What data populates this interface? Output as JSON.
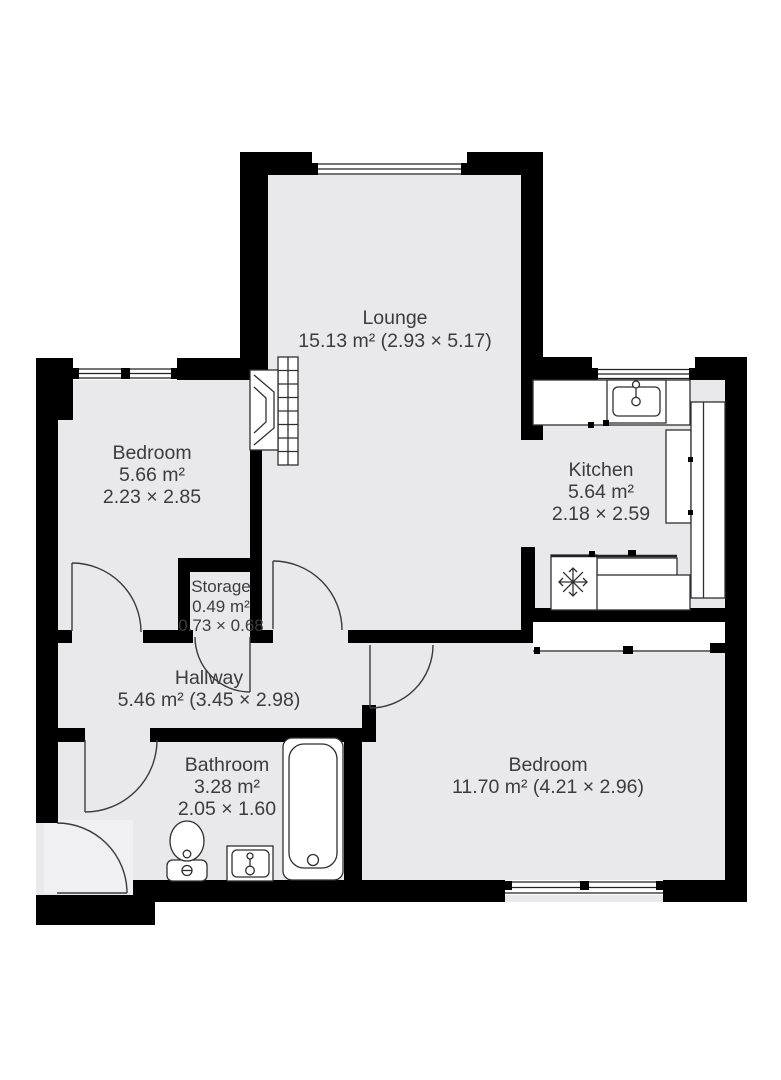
{
  "floorplan": {
    "colors": {
      "background": "#ffffff",
      "floor": "#e9e9ec",
      "wall": "#000000",
      "text": "#3c3c3c",
      "fixture_stroke": "#2f2f2f"
    },
    "rooms": [
      {
        "name": "Lounge",
        "area": "15.13 m² (2.93 × 5.17)"
      },
      {
        "name": "Bedroom",
        "area": "5.66 m²",
        "dims": "2.23 × 2.85"
      },
      {
        "name": "Kitchen",
        "area": "5.64 m²",
        "dims": "2.18 × 2.59"
      },
      {
        "name": "Storage",
        "area": "0.49 m²",
        "dims": "0.73 × 0.68"
      },
      {
        "name": "Hallway",
        "area": "5.46 m² (3.45 × 2.98)"
      },
      {
        "name": "Bathroom",
        "area": "3.28 m²",
        "dims": "2.05 × 1.60"
      },
      {
        "name": "Bedroom",
        "area": "11.70 m² (4.21 × 2.96)"
      }
    ],
    "fixtures": [
      "fireplace-icon",
      "kitchen-sink-icon",
      "freezer-snowflake-icon",
      "kitchen-counter",
      "bathtub-icon",
      "toilet-icon",
      "bathroom-sink-icon"
    ],
    "doors": 6,
    "windows": 4
  }
}
